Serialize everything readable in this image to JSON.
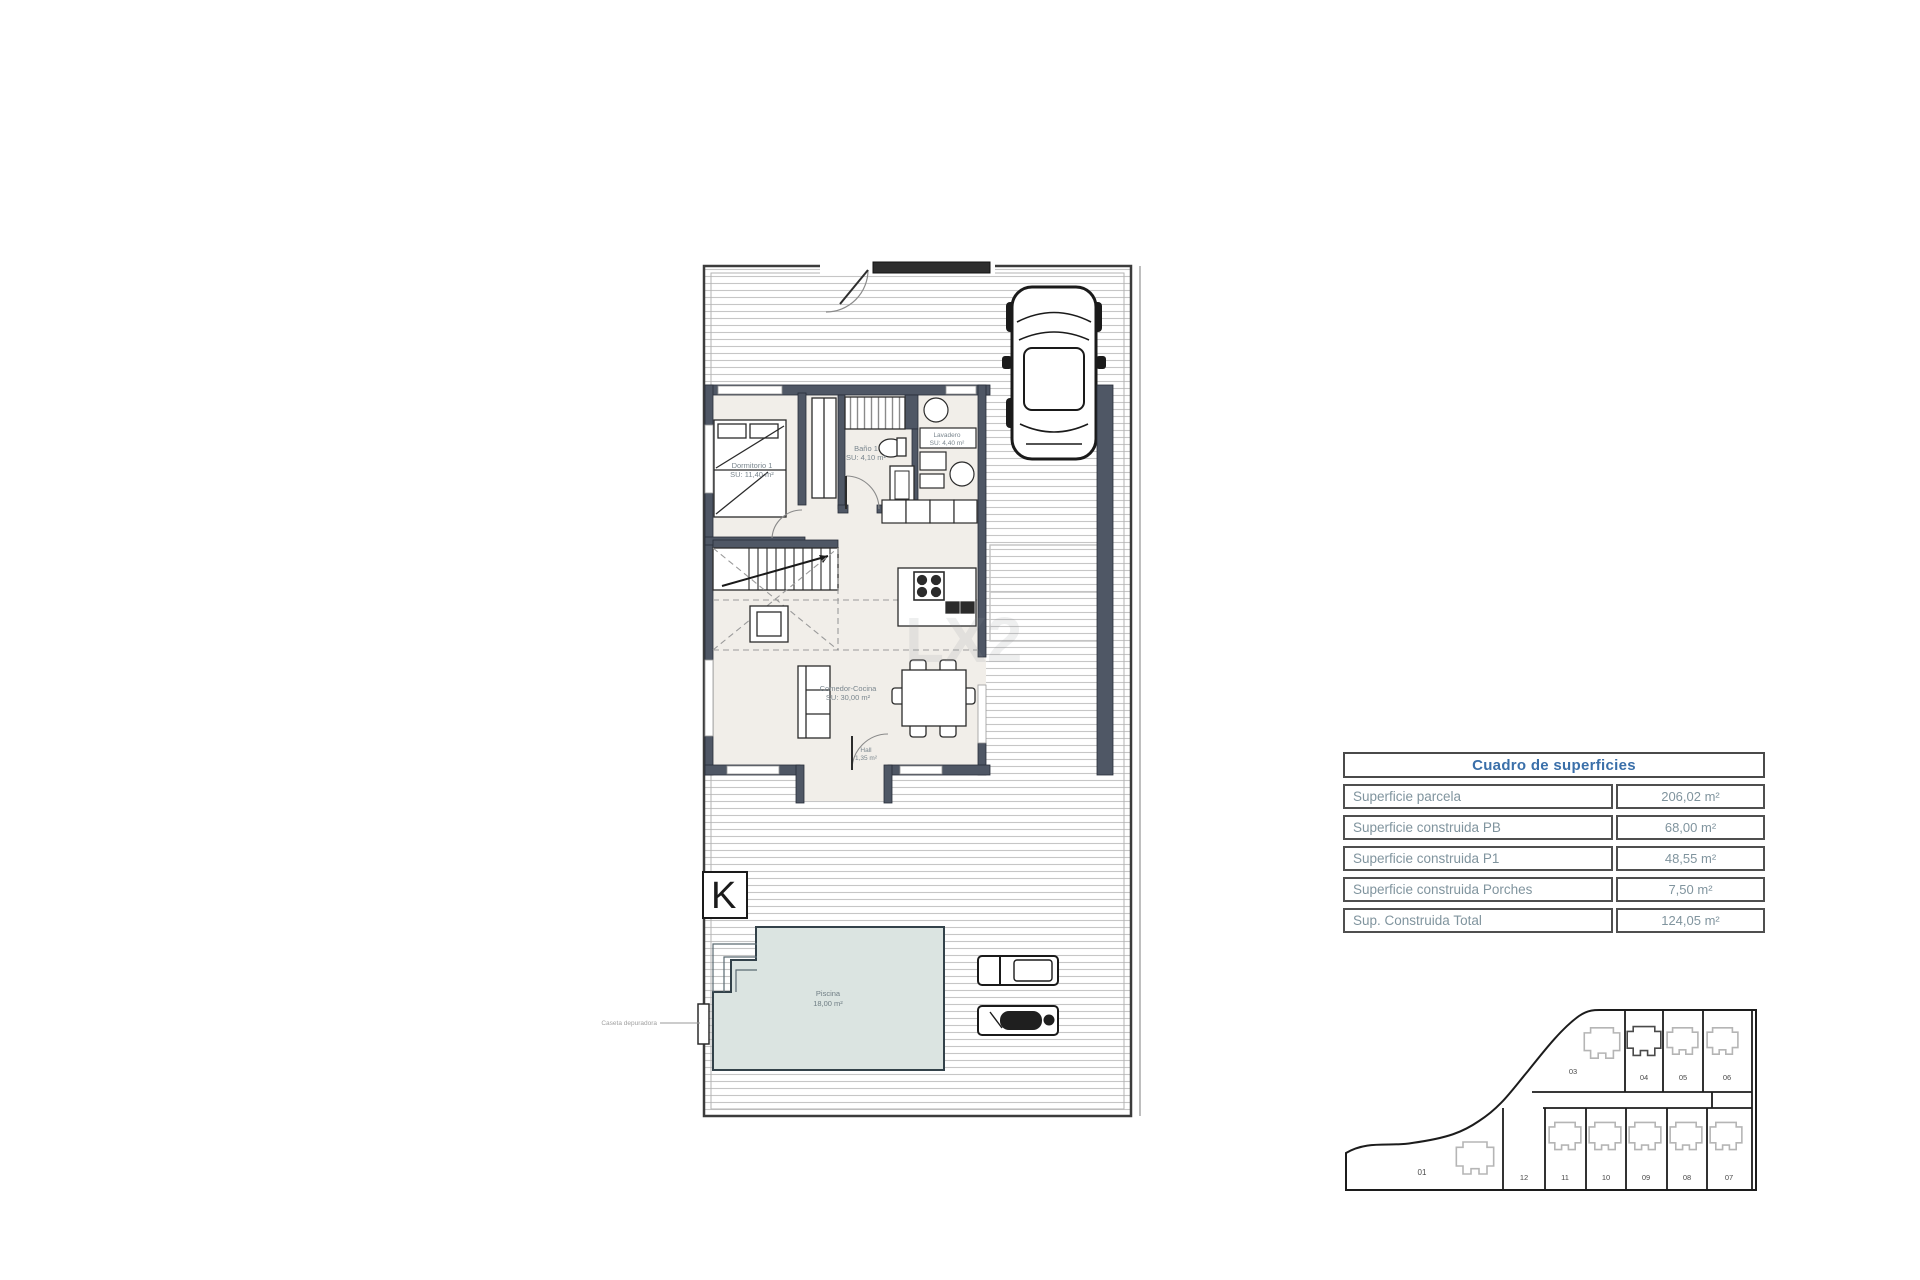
{
  "surface_table": {
    "title": "Cuadro de superficies",
    "rows": [
      {
        "label": "Superficie parcela",
        "value": "206,02 m²"
      },
      {
        "label": "Superficie construida PB",
        "value": "68,00 m²"
      },
      {
        "label": "Superficie construida P1",
        "value": "48,55 m²"
      },
      {
        "label": "Superficie construida Porches",
        "value": "7,50 m²"
      },
      {
        "label": "Sup. Construida Total",
        "value": "124,05 m²"
      }
    ]
  },
  "floor_plan": {
    "rooms": [
      {
        "name": "Dormitorio 1",
        "area": "SU: 11,40 m²"
      },
      {
        "name": "Baño 1",
        "area": "SU: 4,10 m²"
      },
      {
        "name": "Lavadero",
        "area": "SU: 4,40 m²"
      },
      {
        "name": "Comedor-Cocina",
        "area": "SU: 30,00 m²"
      },
      {
        "name": "Hall",
        "area": "1,35 m²"
      },
      {
        "name": "Piscina",
        "area": "18,00 m²"
      }
    ],
    "annotations": {
      "pool_equipment": "Caseta depuradora",
      "orientation_mark": "K",
      "watermark": "LX2"
    }
  },
  "site_plan": {
    "parcel_large_bottom": "01",
    "parcels_top": [
      "03",
      "04",
      "05",
      "06"
    ],
    "highlighted_parcel": "04",
    "parcels_bottom": [
      "12",
      "11",
      "10",
      "09",
      "08",
      "07"
    ]
  },
  "colors": {
    "wall": "#4f5765",
    "floor": "#f1eee9",
    "pool": "#dbe4e1",
    "hatch_line": "#c6c6c6",
    "table_title": "#3a6fa9",
    "table_text": "#80949e",
    "site_highlight": "#8d939d"
  }
}
